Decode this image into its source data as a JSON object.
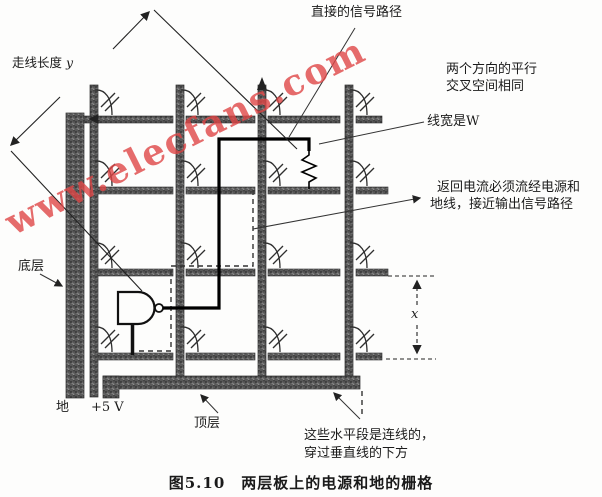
{
  "figure": {
    "watermark": "www.elecfans.com",
    "caption": "图5.10　两层板上的电源和地的栅格",
    "labels": {
      "direct_signal_path": "直接的信号路径",
      "trace_length": "走线长度",
      "trace_length_var": "y",
      "parallel_spacing_line1": "两个方向的平行",
      "parallel_spacing_line2": "交叉空间相同",
      "line_width": "线宽是W",
      "return_current_line1": "返回电流必须流经电源和",
      "return_current_line2": "地线，接近输出信号路径",
      "bottom_layer": "底层",
      "ground": "地",
      "power": "+5 V",
      "top_layer": "顶层",
      "horizontal_segments_line1": "这些水平段是连线的，",
      "horizontal_segments_line2": "穿过垂直线的下方",
      "dim_x_var": "x"
    },
    "colors": {
      "watermark": "#de4646",
      "trace_fill": "#575757",
      "signal_path": "#000000",
      "thin_line": "#3a3a3a"
    }
  }
}
